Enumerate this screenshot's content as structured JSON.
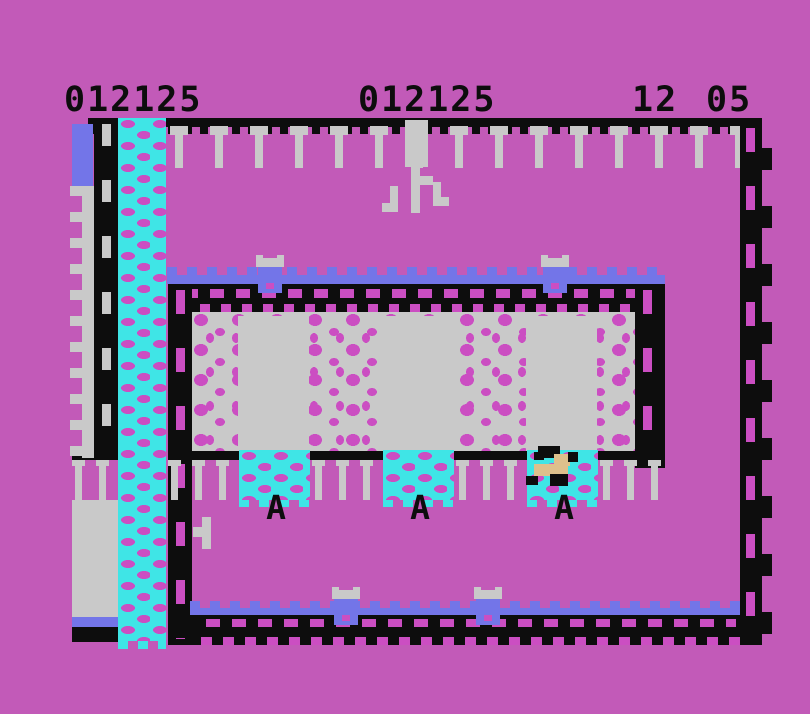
{
  "colors": {
    "bg": "#c25ab8",
    "pink": "#cb4ec2",
    "black": "#0d0d0d",
    "gray": "#c9c9c9",
    "cyan": "#3fe5e6",
    "blue": "#7375e8",
    "tan": "#dec08c"
  },
  "hud": {
    "values": [
      "012125",
      "012125",
      "12",
      "05"
    ]
  },
  "objects": {
    "trestle_glyph": "A"
  }
}
